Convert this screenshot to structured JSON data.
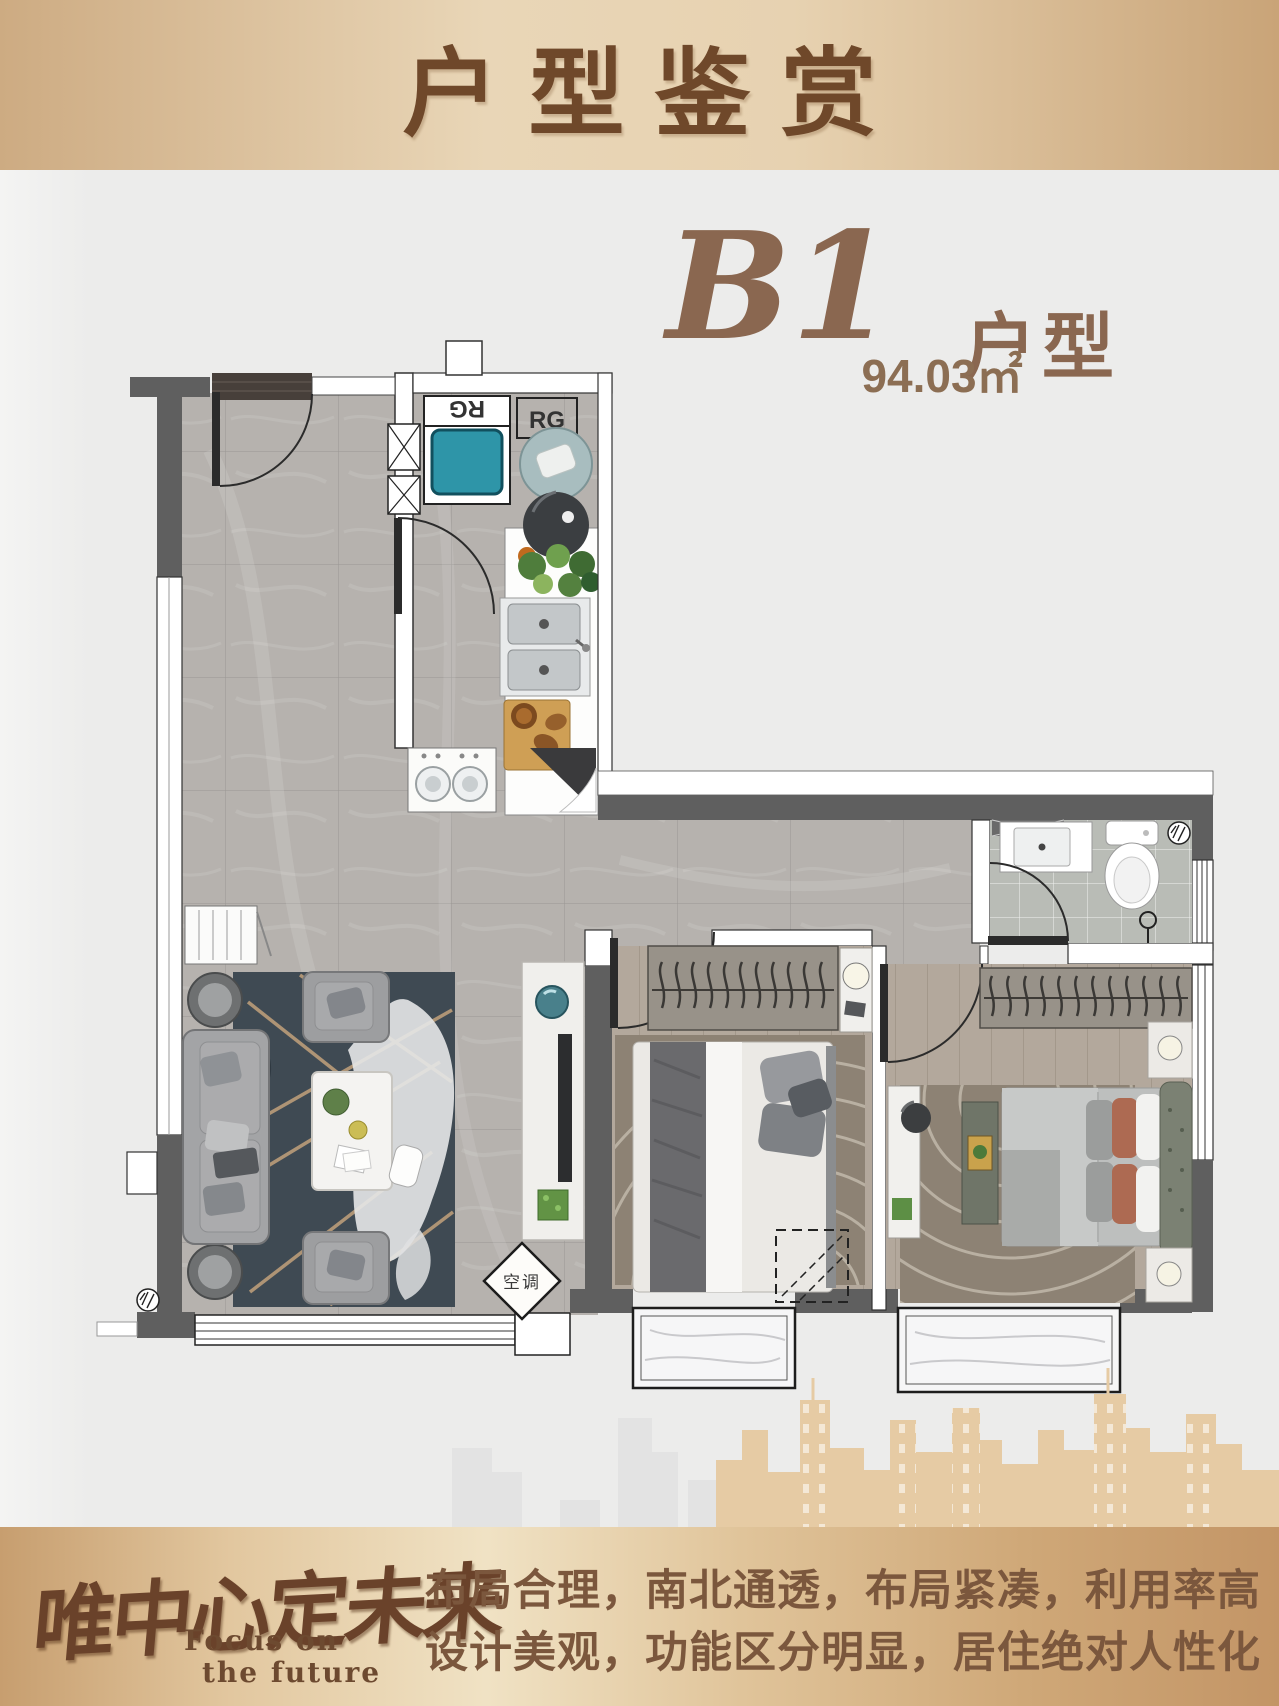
{
  "header": {
    "title": "户型鉴赏"
  },
  "unit": {
    "code": "B1",
    "type_label": "户型",
    "area": "94.03㎡"
  },
  "plan": {
    "labels": {
      "washer_tag": "RG",
      "fridge_tag": "RG",
      "ac_tag": "空调"
    }
  },
  "footer": {
    "logo_zh": "唯中心定未来",
    "logo_en_line1": "Focus on",
    "logo_en_line2": "the future",
    "slogan_line1": "布局合理，南北通透，布局紧凑，利用率高",
    "slogan_line2": "设计美观，功能区分明显，居住绝对人性化"
  },
  "colors": {
    "header_text": "#6f482a",
    "accent_brown": "#8a6750",
    "footer_text": "#7b573d",
    "skyline_tan": "#e6cba4",
    "washer_teal": "#2e95a8",
    "wall_dark": "#5f5f5f"
  }
}
